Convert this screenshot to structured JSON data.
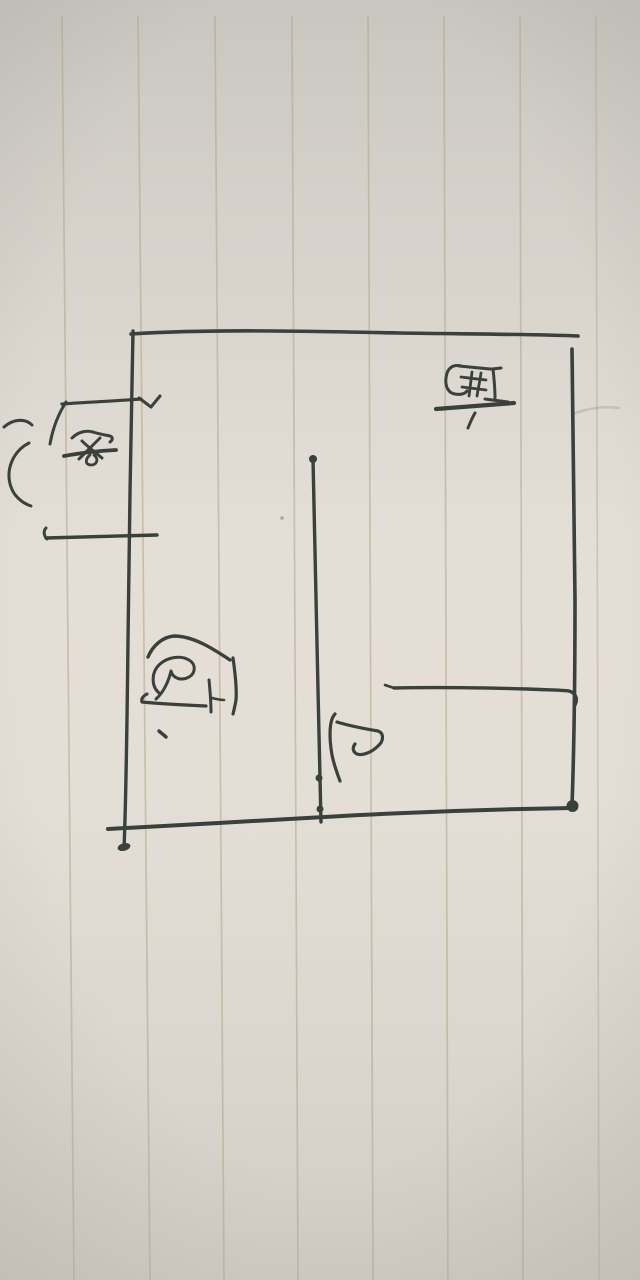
{
  "colors": {
    "paper_mid": "#e3ded6",
    "paper_top": "#c9c6c0",
    "paper_bottom": "#d0ccc4",
    "ink": "#3a403c",
    "ruled_line": "#b3a489"
  },
  "ruled_lines": {
    "count": 8
  },
  "labels": {
    "bedroom": {
      "char": "卧"
    },
    "bathroom": {
      "char": "卫"
    },
    "kitchen": {
      "char": "厨"
    },
    "door": {
      "char": "门"
    }
  }
}
